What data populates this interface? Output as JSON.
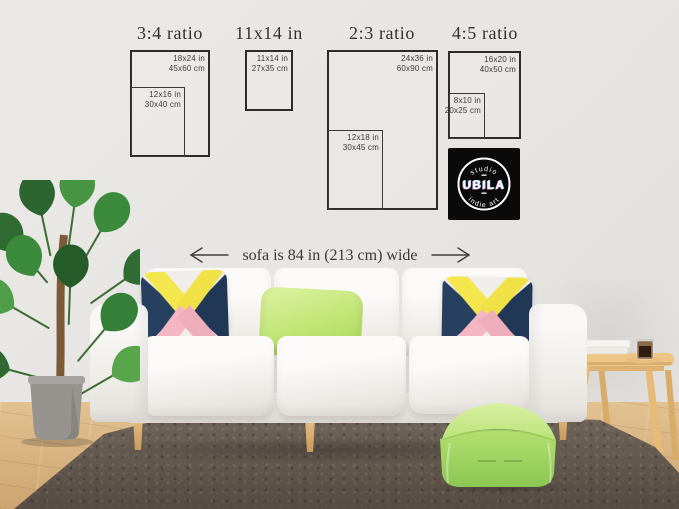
{
  "size_guide": {
    "groups": [
      {
        "title": "3:4 ratio",
        "outer": {
          "line1": "18x24 in",
          "line2": "45x60 cm"
        },
        "inner": {
          "line1": "12x16 in",
          "line2": "30x40 cm"
        }
      },
      {
        "title": "11x14 in",
        "outer": {
          "line1": "11x14 in",
          "line2": "27x35 cm"
        }
      },
      {
        "title": "2:3 ratio",
        "outer": {
          "line1": "24x36 in",
          "line2": "60x90 cm"
        },
        "inner": {
          "line1": "12x18 in",
          "line2": "30x45 cm"
        }
      },
      {
        "title": "4:5 ratio",
        "outer": {
          "line1": "16x20 in",
          "line2": "40x50 cm"
        },
        "inner": {
          "line1": "8x10 in",
          "line2": "20x25 cm"
        }
      }
    ]
  },
  "dimension_note": {
    "text": "sofa is 84 in (213 cm) wide"
  },
  "logo": {
    "arc_top": "studio",
    "name": "UBILA",
    "arc_bottom": "indie art"
  },
  "colors": {
    "wall": "#e7e5e2",
    "floor_wood": "#d7b37f",
    "rug": "#6c6156",
    "sofa_white": "#f7f6f4",
    "sofa_leg_wood": "#d9b275",
    "pillow_navy": "#27405f",
    "pillow_yellow": "#f4e74e",
    "pillow_pink": "#f3b6c2",
    "pillow_green": "#bfe573",
    "pouf_green": "#a8dc69",
    "table_wood": "#e9c07f",
    "plant_green": "#3c8a3c",
    "pot_gray": "#9c9a96",
    "frame_outline": "#2e2c29",
    "guide_text": "#3d3b37",
    "logo_bg": "#0a0a0a",
    "logo_text": "#ffffff"
  }
}
